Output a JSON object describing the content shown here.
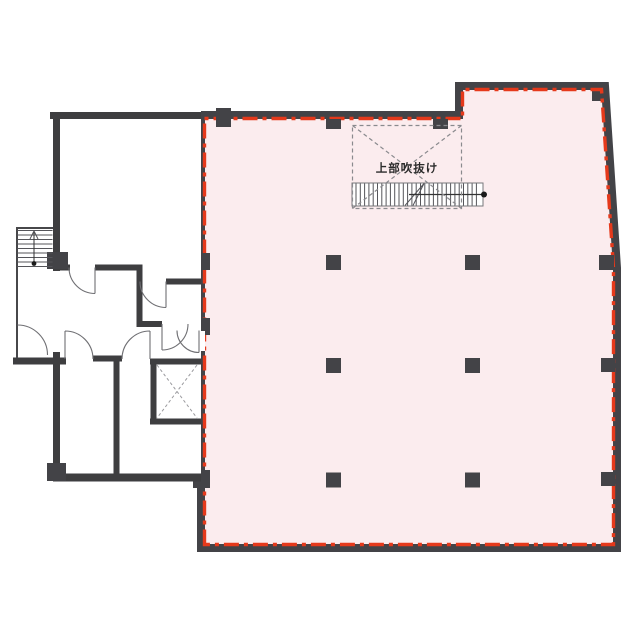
{
  "plan": {
    "void_label": "上部吹抜け",
    "highlighted_zone": "open-floor-area",
    "elevator_marker": "dashed-x",
    "stair_direction_marker": "line-with-dot-and-arrow"
  },
  "colors": {
    "background": "#ffffff",
    "highlight_fill": "#fbecee",
    "boundary_red": "#e5391b",
    "wall_dark": "#434347",
    "building_wall": "#3e3e40",
    "room_fill": "#ffffff",
    "void_dash": "#8a8a8e",
    "text": "#2b2b2b"
  },
  "structure": {
    "columns": {
      "xs": [
        333.5,
        472.5
      ],
      "ys": [
        262.5,
        365.5,
        480
      ],
      "size": 15
    },
    "wall_posts_right_x": 607,
    "interior_stair": {
      "x0": 356,
      "x1": 480.5,
      "y0": 183.5,
      "y1": 205.5,
      "step": 4.3
    },
    "exterior_stair": {
      "x0": 17.5,
      "x1": 52.5,
      "y0": 230.5,
      "y1": 266.5,
      "step": 4.5
    },
    "interior_stair_treads": 29,
    "exterior_stair_treads": 9
  }
}
